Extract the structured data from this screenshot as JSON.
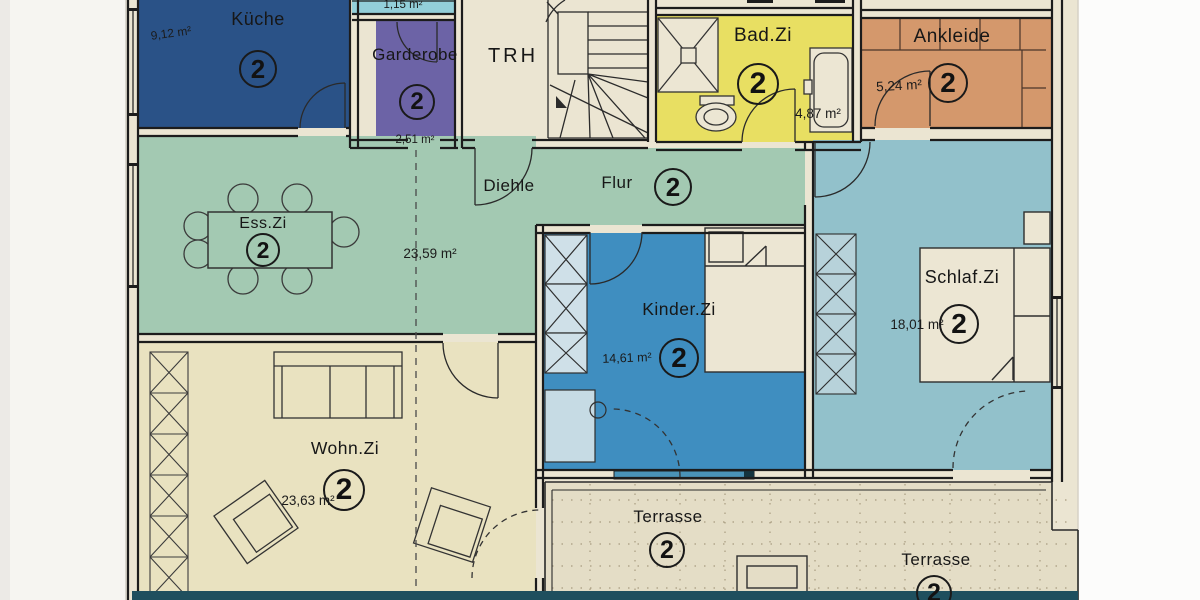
{
  "palette": {
    "wall": "#1c1c1c",
    "paper": "#ebe5d2",
    "margin": "#f6f5f1",
    "terrace": "#e4ddc6",
    "bottom_strip": "#1f4f5e",
    "window_sill": "#4a93b8"
  },
  "rooms": [
    {
      "id": "kueche",
      "name": "Küche",
      "number": "2",
      "area": "9,12 m²",
      "color": "#2a5287"
    },
    {
      "id": "abstellkammer",
      "name": "",
      "number": "",
      "area": "1,15 m²",
      "color": "#93cfd9"
    },
    {
      "id": "garderobe",
      "name": "Garderobe",
      "number": "2",
      "area": "2,51 m²",
      "color": "#6c63a6"
    },
    {
      "id": "treppenhaus",
      "name": "TRH",
      "number": "",
      "area": "",
      "color": "#ebe5d2"
    },
    {
      "id": "bad",
      "name": "Bad.Zi",
      "number": "2",
      "area": "4,87 m²",
      "color": "#e8df62"
    },
    {
      "id": "ankleide",
      "name": "Ankleide",
      "number": "2",
      "area": "5,24 m²",
      "color": "#d4986c"
    },
    {
      "id": "diehle",
      "name": "Diehle",
      "number": "",
      "area": "",
      "color": "#a3c9b2"
    },
    {
      "id": "flur",
      "name": "Flur",
      "number": "2",
      "area": "23,59 m²",
      "color": "#a3c9b2"
    },
    {
      "id": "esszimmer",
      "name": "Ess.Zi",
      "number": "2",
      "area": "",
      "color": "#a3c9b2"
    },
    {
      "id": "kinderzimmer",
      "name": "Kinder.Zi",
      "number": "2",
      "area": "14,61 m²",
      "color": "#3f8ec0"
    },
    {
      "id": "schlafzimmer",
      "name": "Schlaf.Zi",
      "number": "2",
      "area": "18,01 m²",
      "color": "#92c1cb"
    },
    {
      "id": "wohnzimmer",
      "name": "Wohn.Zi",
      "number": "2",
      "area": "23,63 m²",
      "color": "#e9e2c0"
    },
    {
      "id": "terrasse-links",
      "name": "Terrasse",
      "number": "2",
      "area": "",
      "color": "#e4ddc6"
    },
    {
      "id": "terrasse-rechts",
      "name": "Terrasse",
      "number": "2",
      "area": "",
      "color": "#e4ddc6"
    }
  ]
}
